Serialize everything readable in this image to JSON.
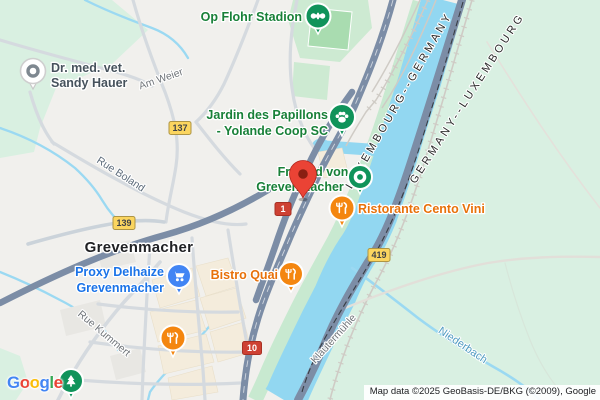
{
  "city": "Grevenmacher",
  "pois": {
    "stadion": {
      "label": "Op Flohr Stadion"
    },
    "vet": {
      "line1": "Dr. med. vet.",
      "line2": "Sandy Hauer"
    },
    "jardin": {
      "line1": "Jardin des Papillons",
      "line2": "- Yolande Coop SC"
    },
    "freibad": {
      "line1": "Freibad von",
      "line2": "Grevenmacher"
    },
    "cento": {
      "label": "Ristorante Cento Vini"
    },
    "proxy": {
      "line1": "Proxy Delhaize",
      "line2": "Grevenmacher"
    },
    "bistro": {
      "label": "Bistro Quai"
    }
  },
  "streets": {
    "am_weier": "Am Weier",
    "rue_boland": "Rue Boland",
    "rue_kummert": "Rue Kummert",
    "klautermuhle": "Klautermühle"
  },
  "water": {
    "niederbach": "Niederbach"
  },
  "borders": {
    "west": "LUXEMBOURG--GERMANY",
    "east": "GERMANY--LUXEMBOURG"
  },
  "badges": {
    "b137": "137",
    "b139": "139",
    "b419": "419",
    "n1": "1",
    "n10": "10"
  },
  "logo": {
    "l0": "G",
    "l1": "o",
    "l2": "o",
    "l3": "g",
    "l4": "l",
    "l5": "e"
  },
  "attribution": "Map data ©2025 GeoBasis-DE/BKG (©2009), Google",
  "colors": {
    "land_lux": "#F1F0ED",
    "land_germany": "#D9F0E2",
    "park_green": "#CDEAD2",
    "water_blue": "#92D7F1",
    "major_road": "#7C8DA6",
    "poi_green_text": "#188038",
    "poi_orange_text": "#E8710A",
    "poi_blue_text": "#1A73E8",
    "badge_yellow": "#FBD55F",
    "badge_red": "#CE4133",
    "marker_red": "#EA4335"
  }
}
